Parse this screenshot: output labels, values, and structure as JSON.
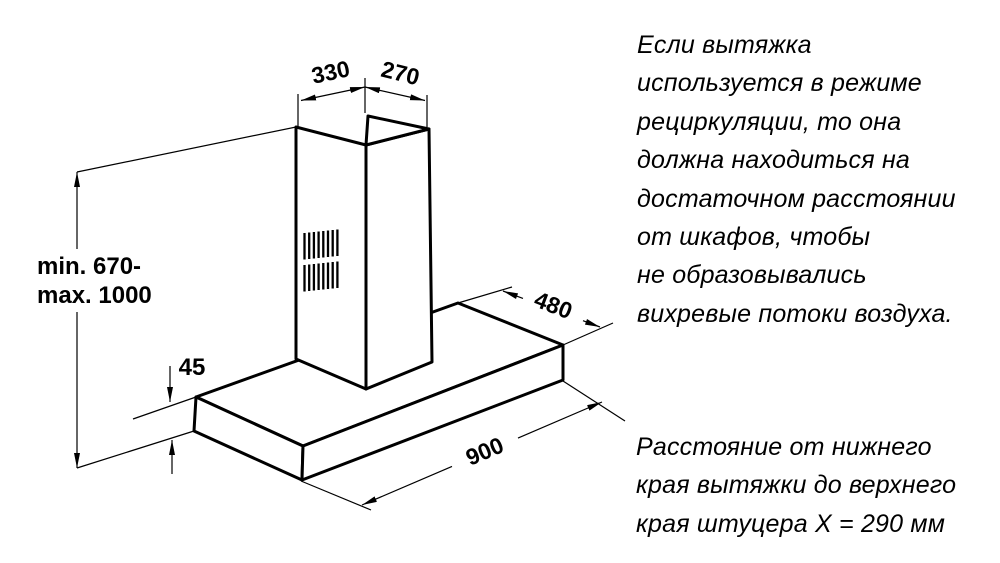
{
  "page": {
    "background_color": "#ffffff",
    "line_color": "#000000"
  },
  "diagram": {
    "dimensions": {
      "chimney_top_left": "330",
      "chimney_top_right": "270",
      "mount_height_line1": "min. 670-",
      "mount_height_line2": "max. 1000",
      "body_height": "45",
      "body_depth": "480",
      "body_width": "900"
    }
  },
  "notes": {
    "recirculation": "Если вытяжка\nиспользуется в режиме\nрециркуляции, то она\nдолжна находиться на\nдостаточном расстоянии\nот шкафов, чтобы\nне образовывались\nвихревые потоки воздуха.",
    "connector_distance": "Расстояние от нижнего\nкрая вытяжки до верхнего\nкрая штуцера X = 290 мм"
  }
}
